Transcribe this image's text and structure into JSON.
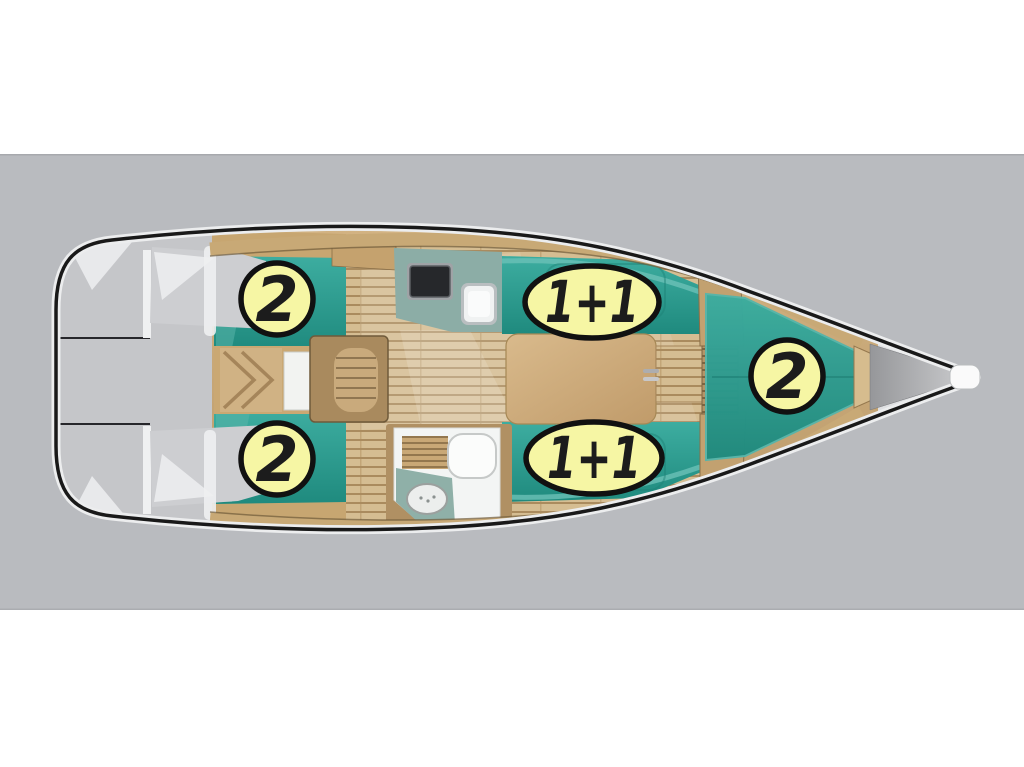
{
  "image": {
    "description": "Top-view deck plan of a sailing yacht with sleeping-capacity badges",
    "orientation": "bow-right"
  },
  "canvas": {
    "width": 1024,
    "height": 767,
    "background": "#ffffff",
    "band": {
      "top": 154,
      "bottom": 610,
      "color": "#b9bbbf"
    }
  },
  "palette": {
    "hull_outline": "#191919",
    "deck_rim": "#ecedee",
    "cockpit_gray": "#c5c6c9",
    "upholstery_teal": "#2a9c90",
    "wood": "#c9a873",
    "plank_light": "#d5bd92",
    "plank_dark": "#aa8b5e",
    "galley_counter": "#8cada6",
    "stove_black": "#26282b",
    "head_floor": "#f3f5f4",
    "badge_fill": "#f6f6a4",
    "badge_border": "#111111",
    "badge_text": "#1c1c1c",
    "bow_locker_gray": "#a9aaad"
  },
  "badges": [
    {
      "area": "aft-cabin-port",
      "shape": "circle",
      "label": "2"
    },
    {
      "area": "aft-cabin-starboard",
      "shape": "circle",
      "label": "2"
    },
    {
      "area": "saloon-settee-port",
      "shape": "ellipse",
      "label": "1+1"
    },
    {
      "area": "saloon-settee-starboard",
      "shape": "ellipse",
      "label": "1+1"
    },
    {
      "area": "forward-cabin",
      "shape": "circle",
      "label": "2"
    }
  ]
}
